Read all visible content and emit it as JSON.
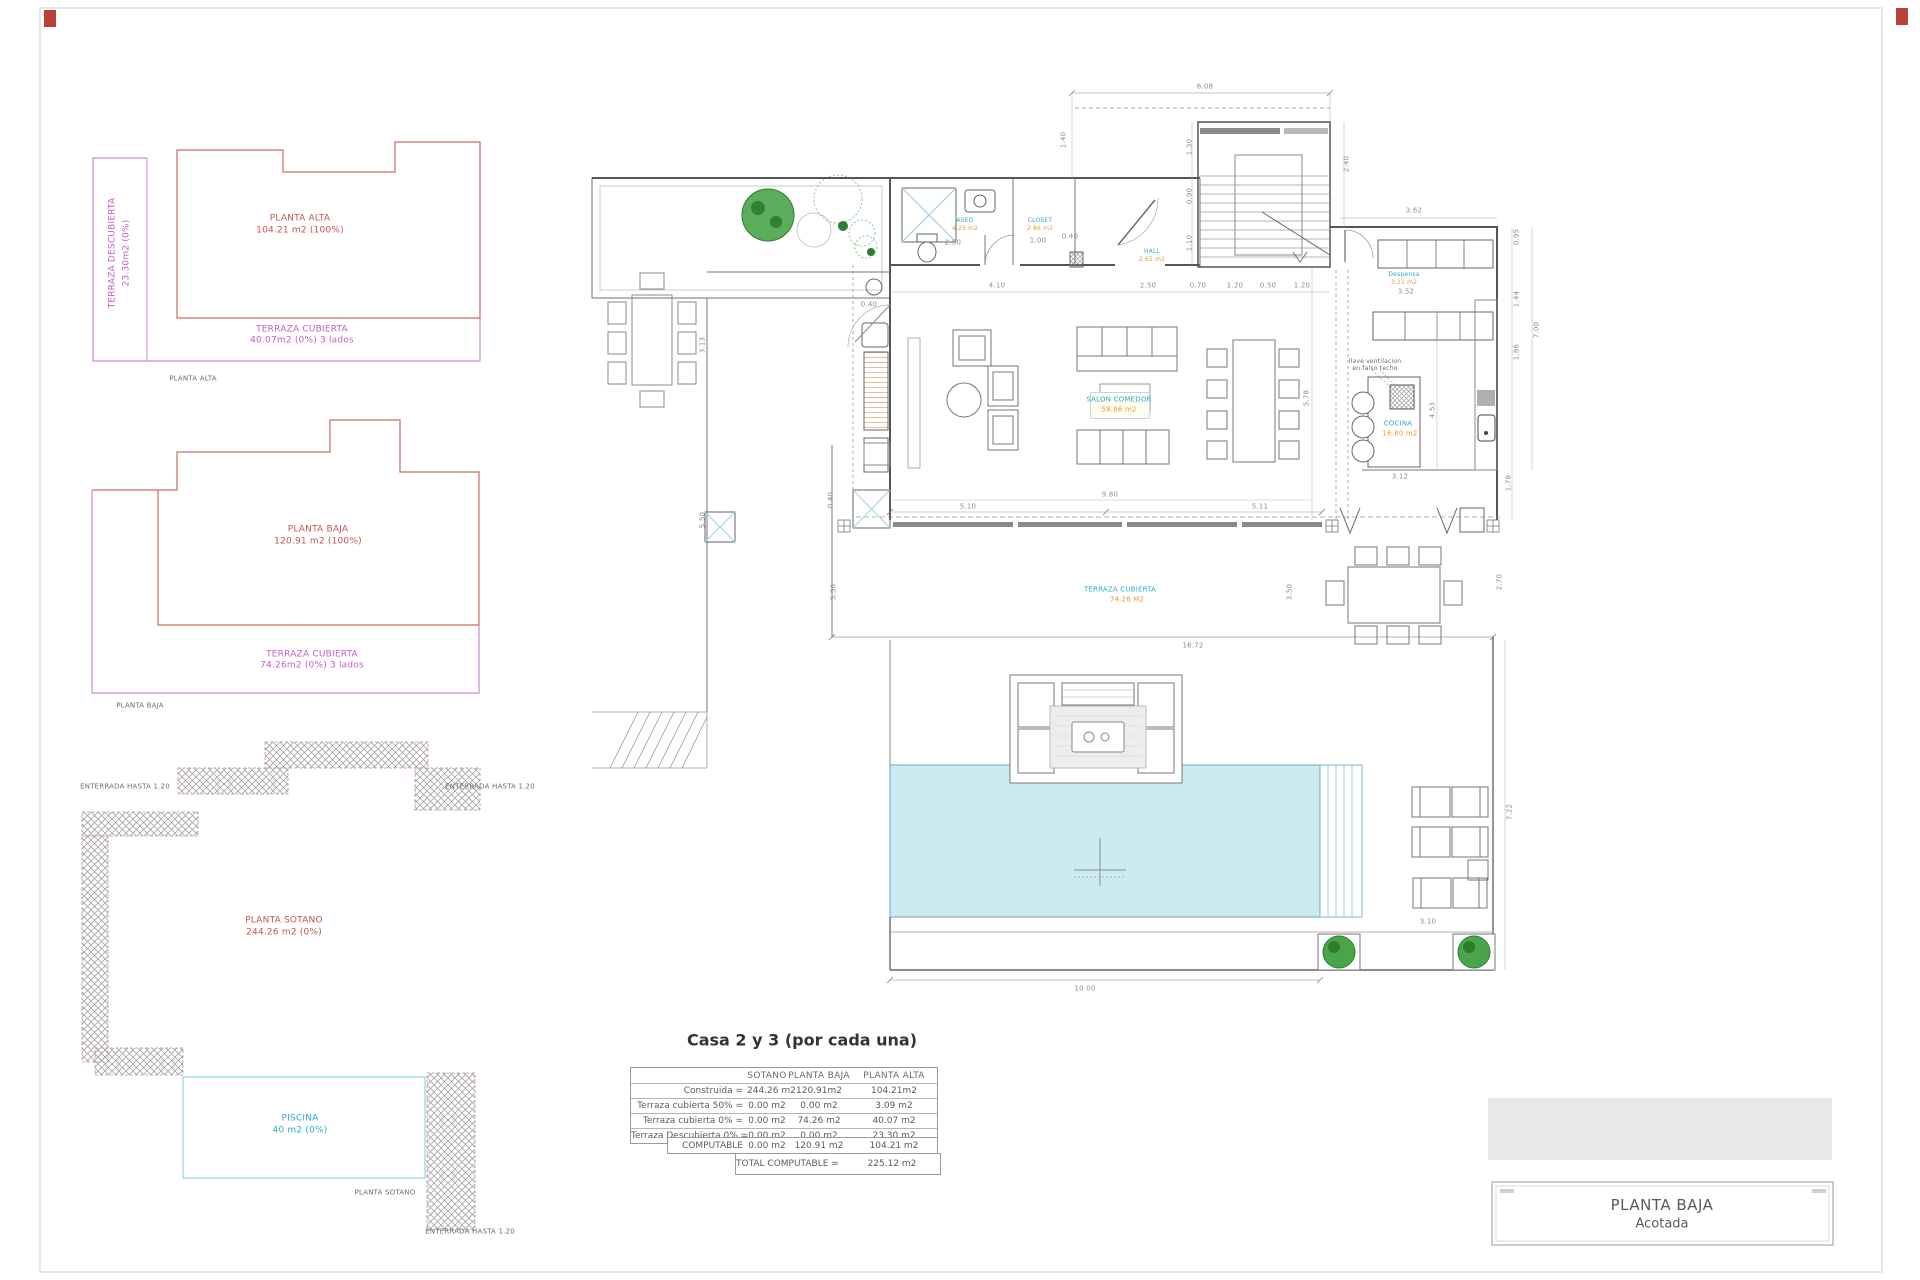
{
  "sheet": {
    "title_block": {
      "title": "PLANTA BAJA",
      "subtitle": "Acotada"
    },
    "summary_table": {
      "title": "Casa 2 y 3 (por cada una)",
      "columns": [
        "SOTANO",
        "PLANTA BAJA",
        "PLANTA ALTA"
      ],
      "rows": [
        {
          "label": "Construida =",
          "values": [
            "244.26 m2",
            "120.91m2",
            "104.21m2"
          ]
        },
        {
          "label": "Terraza cubierta 50% =",
          "values": [
            "0.00 m2",
            "0.00 m2",
            "3.09 m2"
          ]
        },
        {
          "label": "Terraza cubierta 0% =",
          "values": [
            "0.00 m2",
            "74.26 m2",
            "40.07 m2"
          ]
        },
        {
          "label": "Terraza Descubierta 0% =",
          "values": [
            "0.00 m2",
            "0.00 m2",
            "23.30 m2"
          ]
        },
        {
          "label": "COMPUTABLE",
          "values": [
            "0.00 m2",
            "120.91 m2",
            "104.21 m2"
          ]
        }
      ],
      "total": {
        "label": "TOTAL COMPUTABLE =",
        "value": "225.12 m2"
      }
    },
    "colors": {
      "accent_red": "#c4554f",
      "accent_magenta": "#c45ec4",
      "room_cyan": "#2fa9cd",
      "area_orange": "#e09a3c",
      "pool_fill": "#cdeaf3",
      "tree_green": "#4aa54a",
      "hatch_gray": "#a3a3a3"
    },
    "labels": [
      {
        "n": "keyplan-alta-name",
        "t": "PLANTA ALTA",
        "x": 300,
        "y": 219,
        "c": "red",
        "s": 8
      },
      {
        "n": "keyplan-alta-area",
        "t": "104.21 m2 (100%)",
        "x": 300,
        "y": 231,
        "c": "red",
        "s": 8
      },
      {
        "n": "keyplan-alta-terraza-descubierta-name",
        "t": "TERRAZA DESCUBIERTA",
        "x": 113,
        "y": 253,
        "c": "mag",
        "s": 8,
        "r": -90
      },
      {
        "n": "keyplan-alta-terraza-descubierta-area",
        "t": "23.30m2 (0%)",
        "x": 127,
        "y": 253,
        "c": "mag",
        "s": 8,
        "r": -90
      },
      {
        "n": "keyplan-alta-terraza-cubierta-name",
        "t": "TERRAZA CUBIERTA",
        "x": 302,
        "y": 330,
        "c": "mag",
        "s": 8
      },
      {
        "n": "keyplan-alta-terraza-cubierta-area",
        "t": "40.07m2 (0%) 3 lados",
        "x": 302,
        "y": 341,
        "c": "mag",
        "s": 8
      },
      {
        "n": "keyplan-alta-caption",
        "t": "PLANTA ALTA",
        "x": 193,
        "y": 379,
        "c": "dark",
        "s": 6
      },
      {
        "n": "keyplan-baja-name",
        "t": "PLANTA BAJA",
        "x": 318,
        "y": 530,
        "c": "red",
        "s": 8
      },
      {
        "n": "keyplan-baja-area",
        "t": "120.91  m2 (100%)",
        "x": 318,
        "y": 542,
        "c": "red",
        "s": 8
      },
      {
        "n": "keyplan-baja-terraza-cubierta-name",
        "t": "TERRAZA CUBIERTA",
        "x": 312,
        "y": 655,
        "c": "mag",
        "s": 8
      },
      {
        "n": "keyplan-baja-terraza-cubierta-area",
        "t": "74.26m2 (0%) 3 lados",
        "x": 312,
        "y": 666,
        "c": "mag",
        "s": 8
      },
      {
        "n": "keyplan-baja-caption",
        "t": "PLANTA BAJA",
        "x": 140,
        "y": 706,
        "c": "dark",
        "s": 6
      },
      {
        "n": "sotano-note-left",
        "t": "ENTERRADA HASTA  1.20",
        "x": 125,
        "y": 787,
        "c": "dark",
        "s": 6
      },
      {
        "n": "sotano-note-right",
        "t": "ENTERRADA HASTA  1.20",
        "x": 490,
        "y": 787,
        "c": "dark",
        "s": 6
      },
      {
        "n": "keyplan-sotano-name",
        "t": "PLANTA SOTANO",
        "x": 284,
        "y": 921,
        "c": "red",
        "s": 8
      },
      {
        "n": "keyplan-sotano-area",
        "t": "244.26  m2 (0%)",
        "x": 284,
        "y": 933,
        "c": "red",
        "s": 8
      },
      {
        "n": "keyplan-piscina-name",
        "t": "PISCINA",
        "x": 300,
        "y": 1119,
        "c": "cyan",
        "s": 8
      },
      {
        "n": "keyplan-piscina-area",
        "t": "40  m2 (0%)",
        "x": 300,
        "y": 1131,
        "c": "cyan",
        "s": 8
      },
      {
        "n": "keyplan-sotano-caption",
        "t": "PLANTA SOTANO",
        "x": 385,
        "y": 1193,
        "c": "dark",
        "s": 6
      },
      {
        "n": "sotano-note-bottom",
        "t": "ENTERRADA HASTA  1.20",
        "x": 470,
        "y": 1232,
        "c": "dark",
        "s": 6
      },
      {
        "n": "room-aseo-name",
        "t": "ASEO",
        "x": 965,
        "y": 221,
        "c": "cyan",
        "s": 5
      },
      {
        "n": "room-aseo-area",
        "t": "4.25 m2",
        "x": 965,
        "y": 229,
        "c": "org",
        "s": 5
      },
      {
        "n": "room-closet-name",
        "t": "CLOSET",
        "x": 1040,
        "y": 221,
        "c": "cyan",
        "s": 5
      },
      {
        "n": "room-closet-area",
        "t": "2.86 m2",
        "x": 1040,
        "y": 229,
        "c": "org",
        "s": 5
      },
      {
        "n": "room-hall-name",
        "t": "HALL",
        "x": 1152,
        "y": 252,
        "c": "cyan",
        "s": 5
      },
      {
        "n": "room-hall-area",
        "t": "2.65 m2",
        "x": 1152,
        "y": 260,
        "c": "org",
        "s": 5
      },
      {
        "n": "room-salon-name",
        "t": "SALON COMEDOR",
        "x": 1119,
        "y": 400,
        "c": "cyan",
        "s": 6
      },
      {
        "n": "room-salon-area",
        "t": "58.86 m2",
        "x": 1119,
        "y": 410,
        "c": "org",
        "s": 6
      },
      {
        "n": "room-cocina-name",
        "t": "COCINA",
        "x": 1398,
        "y": 424,
        "c": "cyan",
        "s": 6
      },
      {
        "n": "room-cocina-area",
        "t": "16.80 m2",
        "x": 1400,
        "y": 434,
        "c": "org",
        "s": 6
      },
      {
        "n": "room-despensa-name",
        "t": "Despensa",
        "x": 1404,
        "y": 275,
        "c": "cyan",
        "s": 5
      },
      {
        "n": "room-despensa-area",
        "t": "3.21 m2",
        "x": 1404,
        "y": 283,
        "c": "org",
        "s": 5
      },
      {
        "n": "note-ventilacion-line1",
        "t": "llave ventilacion",
        "x": 1375,
        "y": 362,
        "c": "dark",
        "s": 5
      },
      {
        "n": "note-ventilacion-line2",
        "t": "en falso techo",
        "x": 1375,
        "y": 369,
        "c": "dark",
        "s": 5
      },
      {
        "n": "room-terraza-name",
        "t": "TERRAZA CUBIERTA",
        "x": 1120,
        "y": 590,
        "c": "cyan",
        "s": 6
      },
      {
        "n": "room-terraza-area",
        "t": "74.26 M2",
        "x": 1127,
        "y": 600,
        "c": "org",
        "s": 6
      },
      {
        "n": "dim-608",
        "t": "6.08",
        "x": 1205,
        "y": 87,
        "c": "dim",
        "s": 6
      },
      {
        "n": "dim-140",
        "t": "1.40",
        "x": 1064,
        "y": 140,
        "c": "dim",
        "s": 6,
        "r": -90
      },
      {
        "n": "dim-130",
        "t": "1.30",
        "x": 1190,
        "y": 147,
        "c": "dim",
        "s": 6,
        "r": -90
      },
      {
        "n": "dim-090",
        "t": "0.90",
        "x": 1190,
        "y": 196,
        "c": "dim",
        "s": 6,
        "r": -90
      },
      {
        "n": "dim-110",
        "t": "1.10",
        "x": 1190,
        "y": 243,
        "c": "dim",
        "s": 6,
        "r": -90
      },
      {
        "n": "dim-240",
        "t": "2.40",
        "x": 1347,
        "y": 164,
        "c": "dim",
        "s": 6,
        "r": -90
      },
      {
        "n": "dim-362",
        "t": "3.62",
        "x": 1414,
        "y": 211,
        "c": "dim",
        "s": 6
      },
      {
        "n": "dim-352",
        "t": "3.52",
        "x": 1406,
        "y": 292,
        "c": "dim",
        "s": 6
      },
      {
        "n": "dim-250-aseo",
        "t": "2.50",
        "x": 953,
        "y": 243,
        "c": "dim",
        "s": 6
      },
      {
        "n": "dim-100",
        "t": "1.00",
        "x": 1038,
        "y": 241,
        "c": "dim",
        "s": 6
      },
      {
        "n": "dim-040-closet",
        "t": "0.40",
        "x": 1070,
        "y": 237,
        "c": "dim",
        "s": 6
      },
      {
        "n": "dim-410",
        "t": "4.10",
        "x": 997,
        "y": 286,
        "c": "dim",
        "s": 6
      },
      {
        "n": "dim-250",
        "t": "2.50",
        "x": 1148,
        "y": 286,
        "c": "dim",
        "s": 6
      },
      {
        "n": "dim-070",
        "t": "0.70",
        "x": 1198,
        "y": 286,
        "c": "dim",
        "s": 6
      },
      {
        "n": "dim-120a",
        "t": "1.20",
        "x": 1235,
        "y": 286,
        "c": "dim",
        "s": 6
      },
      {
        "n": "dim-050",
        "t": "0.50",
        "x": 1268,
        "y": 286,
        "c": "dim",
        "s": 6
      },
      {
        "n": "dim-120b",
        "t": "1.20",
        "x": 1302,
        "y": 286,
        "c": "dim",
        "s": 6
      },
      {
        "n": "dim-040-wall",
        "t": "0.40",
        "x": 869,
        "y": 305,
        "c": "dim",
        "s": 6
      },
      {
        "n": "dim-313",
        "t": "3.13",
        "x": 703,
        "y": 345,
        "c": "dim",
        "s": 6,
        "r": -90
      },
      {
        "n": "dim-550-left",
        "t": "5.50",
        "x": 703,
        "y": 520,
        "c": "dim",
        "s": 6,
        "r": -90
      },
      {
        "n": "dim-040-terr",
        "t": "0.40",
        "x": 831,
        "y": 500,
        "c": "dim",
        "s": 6,
        "r": -90
      },
      {
        "n": "dim-550",
        "t": "5.50",
        "x": 834,
        "y": 592,
        "c": "dim",
        "s": 6,
        "r": -90
      },
      {
        "n": "dim-578",
        "t": "5.78",
        "x": 1307,
        "y": 398,
        "c": "dim",
        "s": 6,
        "r": -90
      },
      {
        "n": "dim-453",
        "t": "4.53",
        "x": 1433,
        "y": 410,
        "c": "dim",
        "s": 6,
        "r": -90
      },
      {
        "n": "dim-980",
        "t": "9.80",
        "x": 1110,
        "y": 495,
        "c": "dim",
        "s": 6
      },
      {
        "n": "dim-510",
        "t": "5.10",
        "x": 968,
        "y": 507,
        "c": "dim",
        "s": 6
      },
      {
        "n": "dim-511",
        "t": "5.11",
        "x": 1260,
        "y": 507,
        "c": "dim",
        "s": 6
      },
      {
        "n": "dim-312",
        "t": "3.12",
        "x": 1400,
        "y": 477,
        "c": "dim",
        "s": 6
      },
      {
        "n": "dim-1672",
        "t": "16.72",
        "x": 1193,
        "y": 646,
        "c": "dim",
        "s": 6
      },
      {
        "n": "dim-350",
        "t": "3.50",
        "x": 1290,
        "y": 592,
        "c": "dim",
        "s": 6,
        "r": -90
      },
      {
        "n": "dim-270",
        "t": "2.70",
        "x": 1500,
        "y": 582,
        "c": "dim",
        "s": 6,
        "r": -90
      },
      {
        "n": "dim-178",
        "t": "1.78",
        "x": 1509,
        "y": 483,
        "c": "dim",
        "s": 6,
        "r": -90
      },
      {
        "n": "dim-095",
        "t": "0.95",
        "x": 1517,
        "y": 237,
        "c": "dim",
        "s": 6,
        "r": -90
      },
      {
        "n": "dim-144",
        "t": "1.44",
        "x": 1517,
        "y": 299,
        "c": "dim",
        "s": 6,
        "r": -90
      },
      {
        "n": "dim-186",
        "t": "1.86",
        "x": 1517,
        "y": 352,
        "c": "dim",
        "s": 6,
        "r": -90
      },
      {
        "n": "dim-700",
        "t": "7.00",
        "x": 1537,
        "y": 330,
        "c": "dim",
        "s": 6,
        "r": -90
      },
      {
        "n": "dim-1000",
        "t": "10.00",
        "x": 1085,
        "y": 989,
        "c": "dim",
        "s": 6
      },
      {
        "n": "dim-722",
        "t": "7.22",
        "x": 1510,
        "y": 812,
        "c": "dim",
        "s": 6,
        "r": -90
      },
      {
        "n": "dim-310",
        "t": "3.10",
        "x": 1428,
        "y": 922,
        "c": "dim",
        "s": 6
      }
    ]
  }
}
